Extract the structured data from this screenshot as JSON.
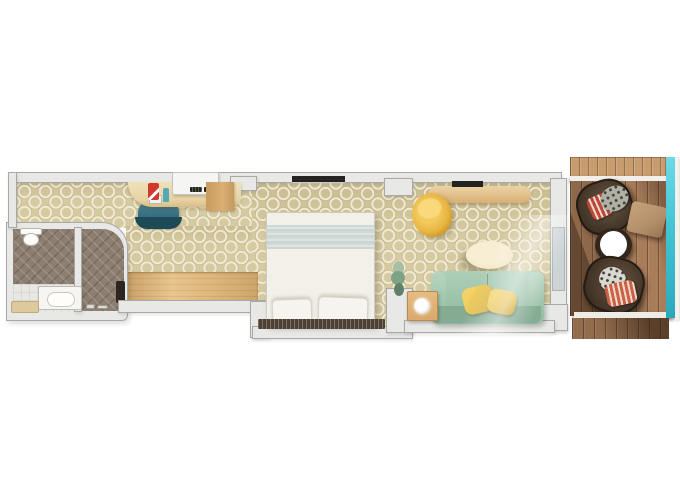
{
  "meta": {
    "scene": "cruise-ship-balcony-stateroom-floor-plan",
    "view": "top-down-3d-render",
    "visible_text": "none"
  },
  "palette": {
    "wall_fill": "#e8e8e6",
    "wall_edge": "#a8a8a5",
    "door": "#ccd4d6",
    "carpet": "#d6caa2",
    "wood_floor": "#dfb97e",
    "bath_floor": "#8c7e70",
    "bath_tile": "#e9e7e2",
    "desk": "#e8d3a6",
    "cabinet": "#d9af74",
    "chair_teal": "#346d7e",
    "chair_teal_dark": "#1d4a57",
    "tv_console": "#f5f5f3",
    "funnel_red": "#cf3a2c",
    "bottle_teal": "#52aab6",
    "bed": "#f2f0e9",
    "bed_band": "#cbd6d4",
    "pillow_white": "#f6f4ef",
    "headboard": "#4c4035",
    "art_dark": "#23231f",
    "sofa": "#9dc3ac",
    "sofa_dark": "#85ac93",
    "pillow_gold": "#e2bd4a",
    "saucer": "#e8b440",
    "table_cream": "#f4e7c7",
    "side_table": "#d9a96e",
    "plant": "#7da287",
    "deck": "#a87d5a",
    "deck_light": "#c79c6e",
    "wicker": "#3e3126",
    "ottoman": "#b3906c",
    "glass": "#45c7d8",
    "pillow_red": "#c04638",
    "pillow_cream": "#ecdccd",
    "pillow_gray": "#b0b0a4",
    "pillow_orange": "#cd6045"
  },
  "rooms": [
    {
      "id": "bathroom",
      "items": [
        "toilet",
        "vanity-sink",
        "shower",
        "shower-panel",
        "bath-mat"
      ]
    },
    {
      "id": "entry-desk-area",
      "items": [
        "desk",
        "desk-chair",
        "tv-console",
        "funnel-ornament",
        "bottle",
        "tall-cabinet",
        "wood-floor-strip"
      ]
    },
    {
      "id": "bedroom",
      "items": [
        "double-bed",
        "bed-pillow",
        "bed-pillow",
        "headboard",
        "wall-art"
      ]
    },
    {
      "id": "living-area",
      "items": [
        "sofa",
        "gold-throw-pillow",
        "gold-throw-pillow",
        "coffee-table",
        "saucer-chair",
        "dresser",
        "wall-tv",
        "side-table",
        "table-lamp",
        "plant",
        "balcony-door"
      ]
    },
    {
      "id": "balcony",
      "items": [
        "wood-deck",
        "wicker-chair",
        "wicker-chair",
        "ottoman",
        "round-table",
        "glass-railing",
        "balcony-divider",
        "balcony-divider"
      ]
    }
  ]
}
